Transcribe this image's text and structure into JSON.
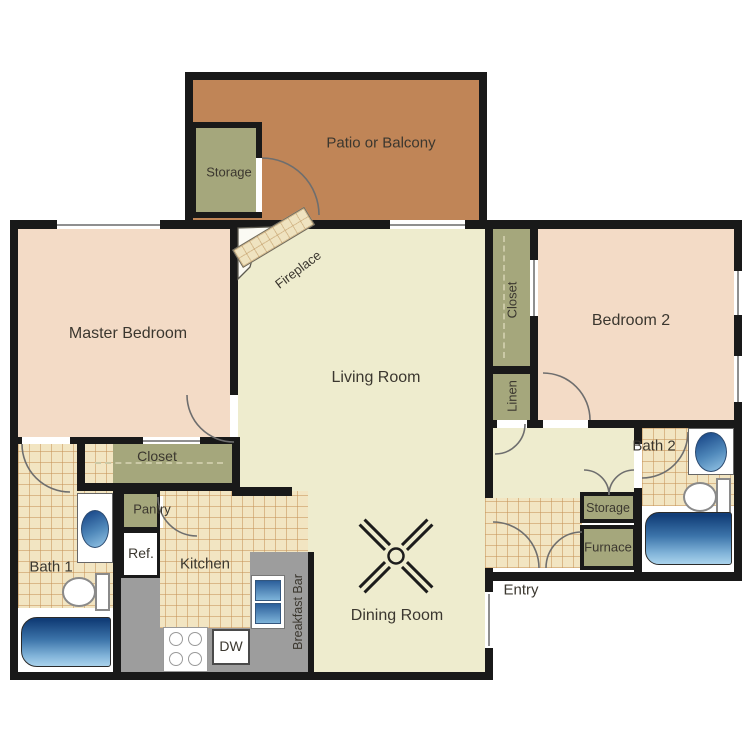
{
  "plan": {
    "title": "Two-bedroom apartment floor plan",
    "rooms": {
      "patio": {
        "label": "Patio or Balcony"
      },
      "storage_patio": {
        "label": "Storage"
      },
      "master_bedroom": {
        "label": "Master Bedroom"
      },
      "living_room": {
        "label": "Living Room"
      },
      "fireplace": {
        "label": "Fireplace"
      },
      "bedroom2": {
        "label": "Bedroom 2"
      },
      "closet_bedroom2": {
        "label": "Closet"
      },
      "linen": {
        "label": "Linen"
      },
      "bath2": {
        "label": "Bath 2"
      },
      "storage_hall": {
        "label": "Storage"
      },
      "furnace": {
        "label": "Furnace"
      },
      "entry": {
        "label": "Entry"
      },
      "dining_room": {
        "label": "Dining Room"
      },
      "kitchen": {
        "label": "Kitchen"
      },
      "closet_master": {
        "label": "Closet"
      },
      "pantry": {
        "label": "Pantry"
      },
      "refrigerator": {
        "label": "Ref."
      },
      "dishwasher": {
        "label": "DW"
      },
      "breakfast_bar": {
        "label": "Breakfast Bar"
      },
      "bath1": {
        "label": "Bath 1"
      }
    },
    "colors": {
      "wall": "#191919",
      "bedroom_floor": "#f3dbc6",
      "living_floor": "#eeecce",
      "closet_olive": "#a5a77c",
      "patio_terracotta": "#c08557",
      "tile_floor": "#f2e5c2",
      "counter_gray": "#9d9d9d",
      "fixture_blue_dark": "#123e78",
      "fixture_blue_light": "#aad3ec"
    }
  }
}
